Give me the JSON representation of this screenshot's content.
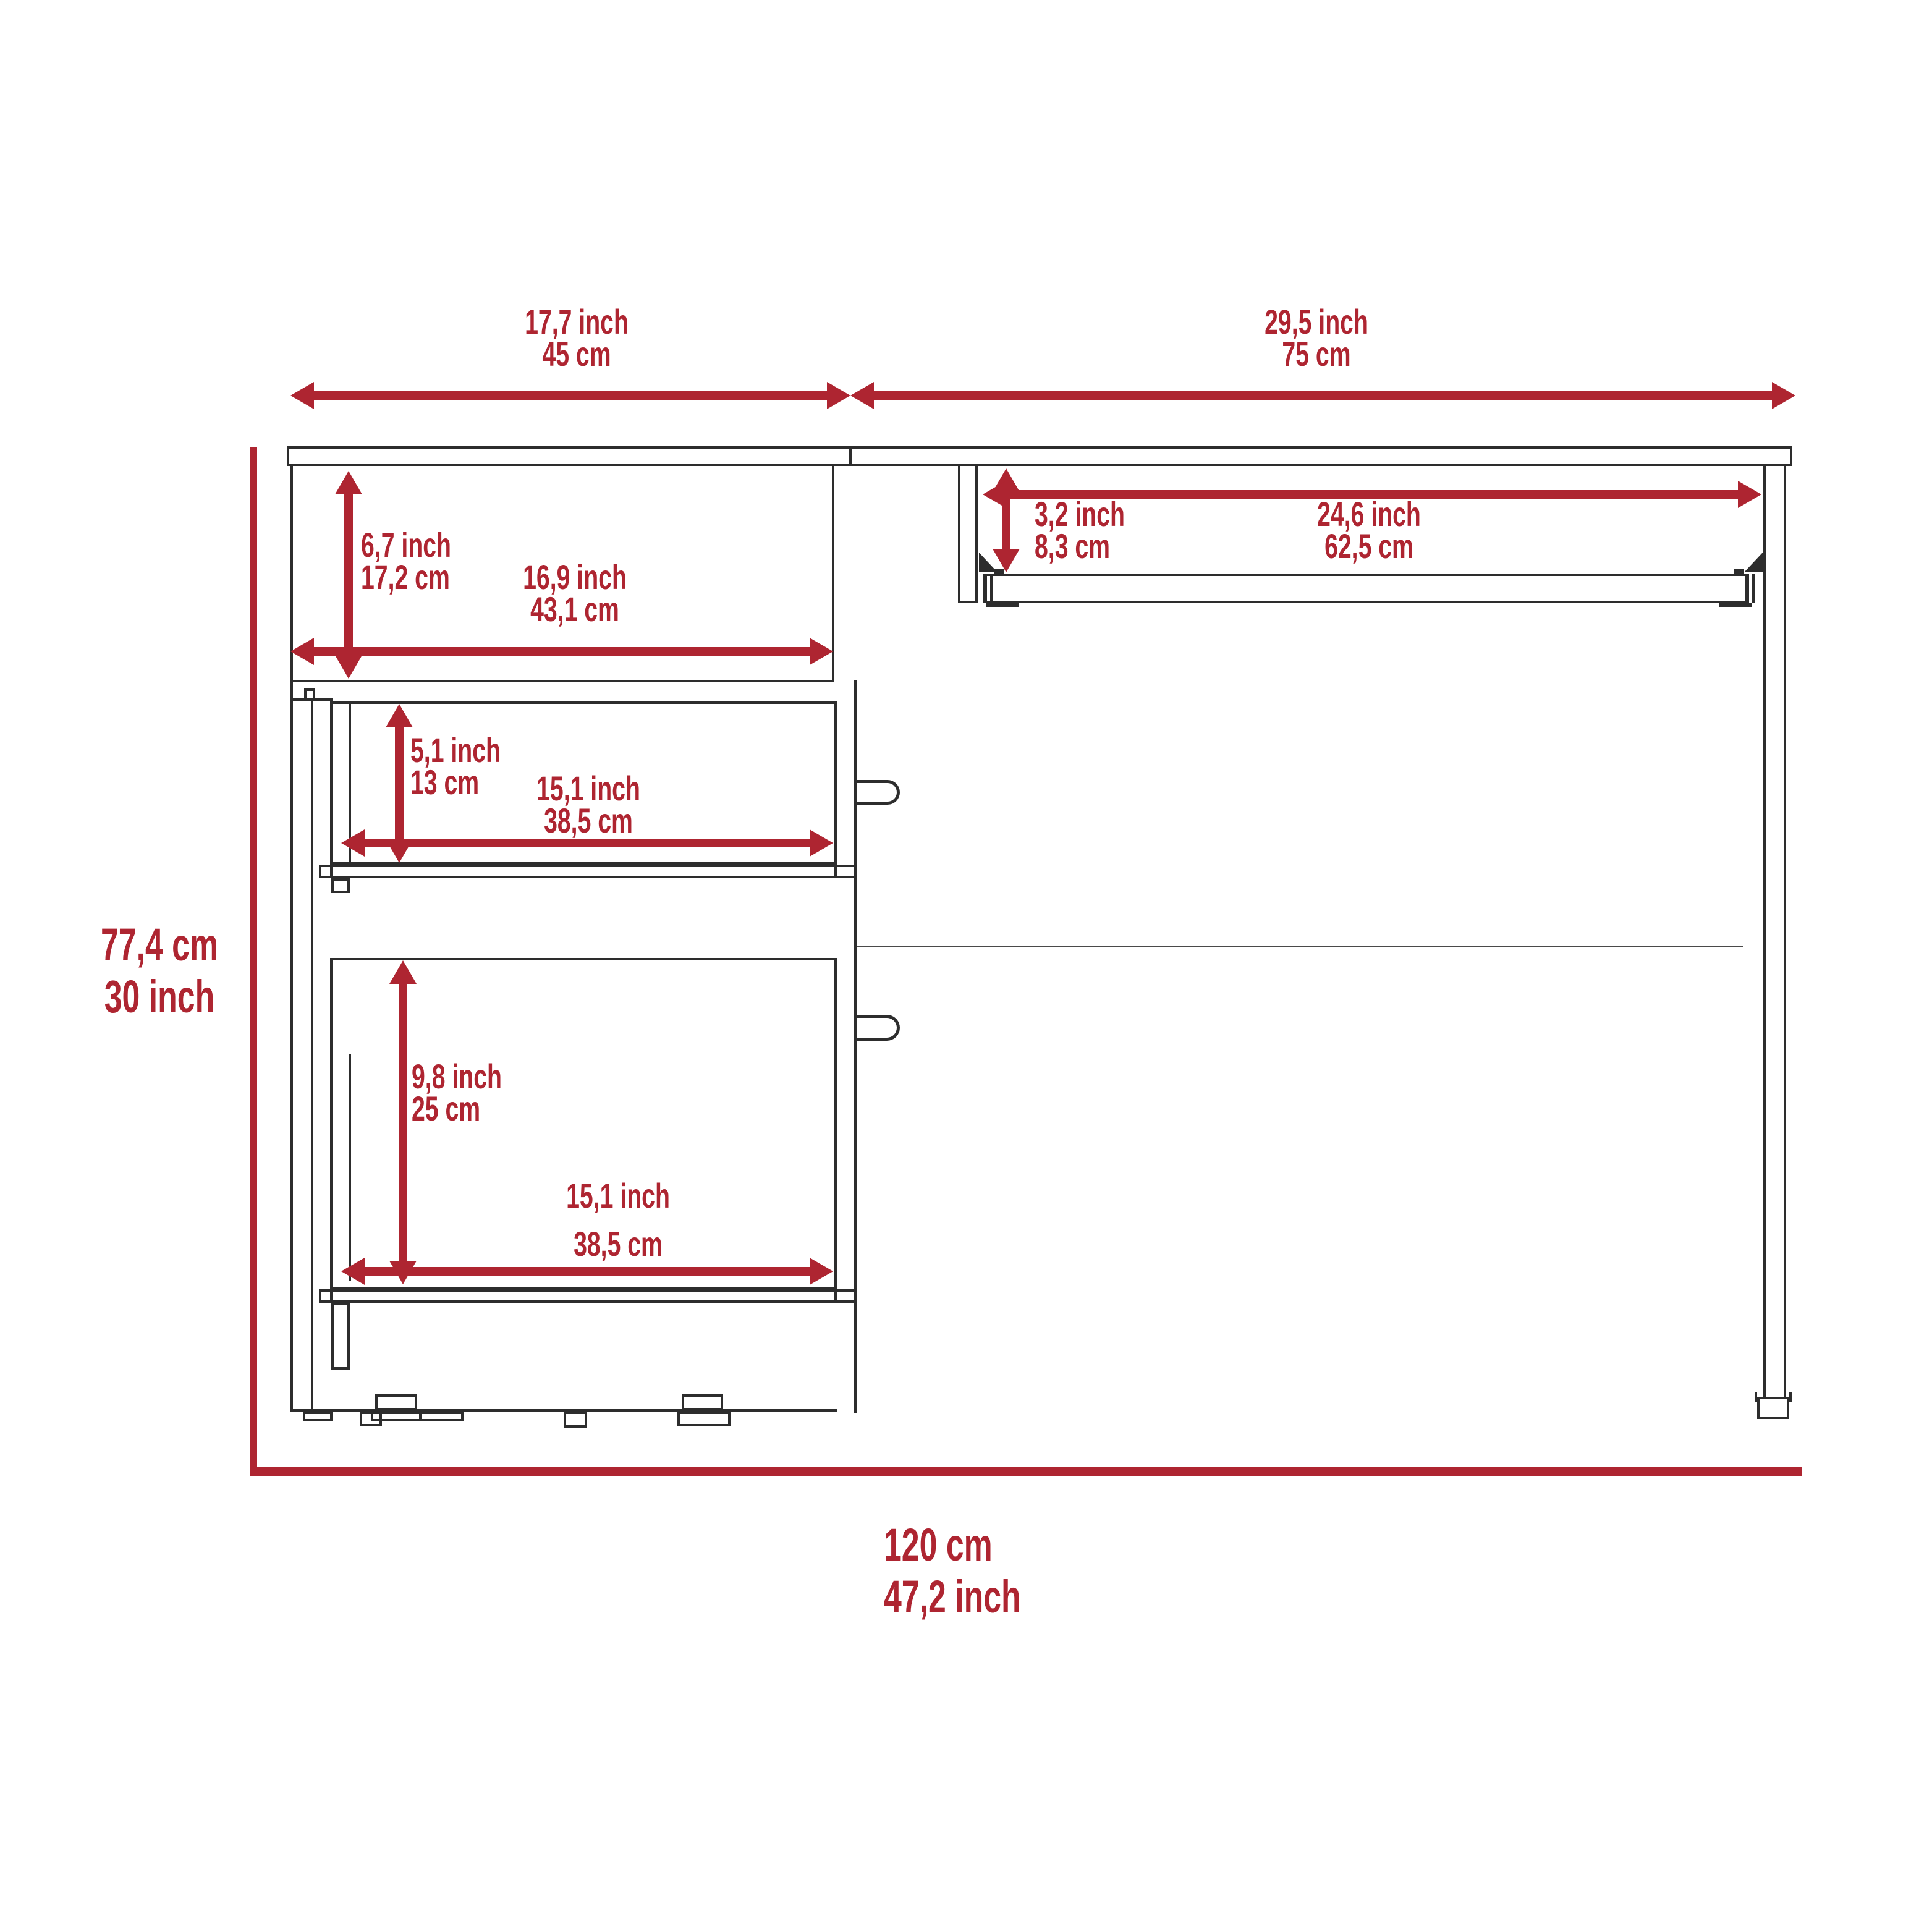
{
  "colors": {
    "red": "#ae2531",
    "line": "#2d2d2d",
    "thin": "#4a4a4a",
    "bg": "#ffffff"
  },
  "dimensions": {
    "top_left_width": {
      "line1": "17,7 inch",
      "line2": "45 cm"
    },
    "top_right_width": {
      "line1": "29,5 inch",
      "line2": "75 cm"
    },
    "overall_height": {
      "line1": "77,4 cm",
      "line2": "30 inch"
    },
    "overall_width": {
      "line1": "120 cm",
      "line2": "47,2 inch"
    },
    "open_shelf_height": {
      "line1": "6,7 inch",
      "line2": "17,2 cm"
    },
    "open_shelf_width": {
      "line1": "16,9 inch",
      "line2": "43,1 cm"
    },
    "drawer1_height": {
      "line1": "5,1 inch",
      "line2": "13 cm"
    },
    "drawer1_width": {
      "line1": "15,1 inch",
      "line2": "38,5 cm"
    },
    "drawer2_height": {
      "line1": "9,8 inch",
      "line2": "25 cm"
    },
    "drawer2_width": {
      "line1": "15,1 inch",
      "line2": "38,5 cm"
    },
    "tray_clearance_height": {
      "line1": "3,2 inch",
      "line2": "8,3 cm"
    },
    "tray_width": {
      "line1": "24,6 inch",
      "line2": "62,5 cm"
    }
  }
}
